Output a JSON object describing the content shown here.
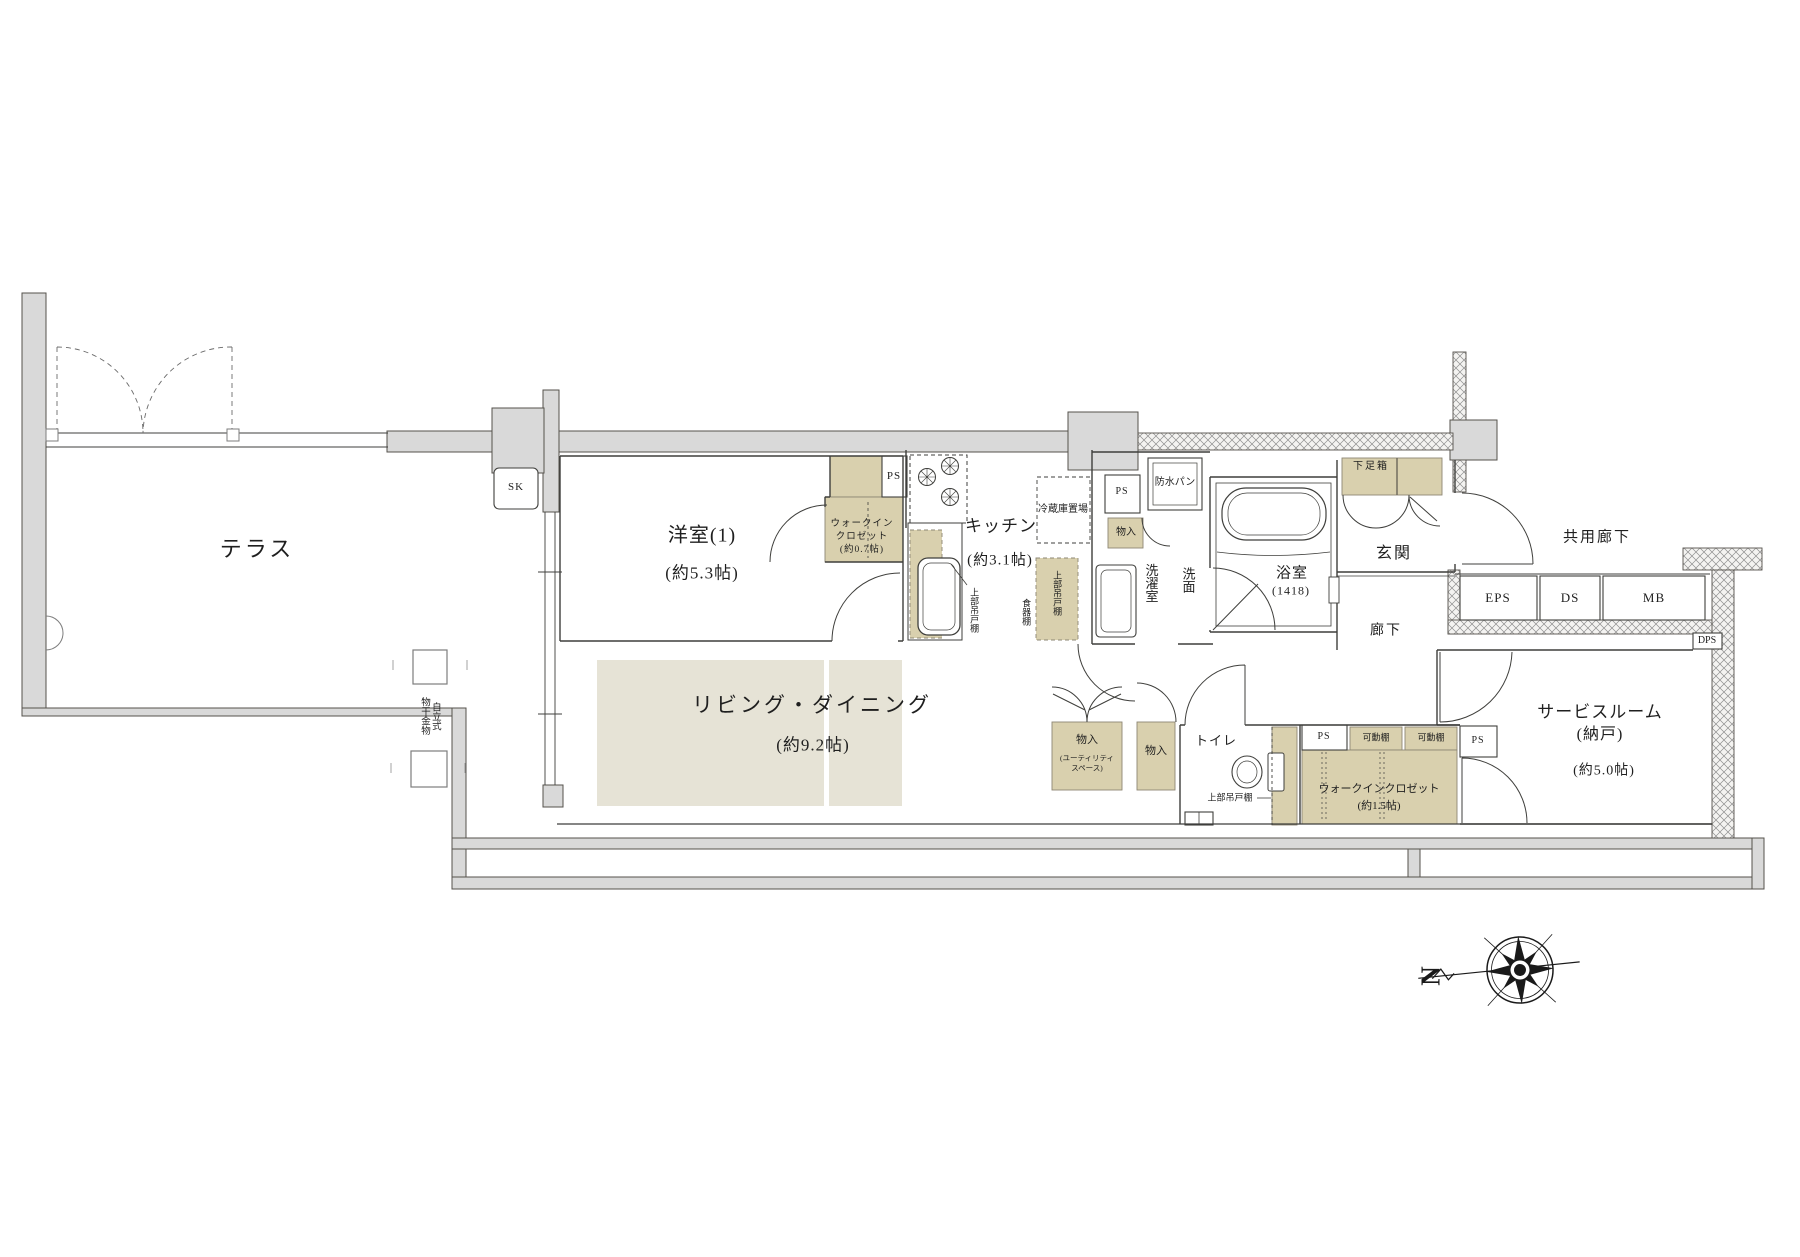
{
  "title": "マンション間取り図 (1LDK+S)",
  "colors": {
    "wall_gray": "#d9d9d9",
    "wall_edge": "#55524c",
    "line": "#3f3f3c",
    "closet_beige": "#d9d0ae",
    "floor_beige": "#e6e3d6",
    "hatch_line": "#8f8f8f"
  },
  "rooms": {
    "terrace": "テラス",
    "western1": "洋室(1)",
    "western1_size": "(約5.3帖)",
    "living": "リビング・ダイニング",
    "living_size": "(約9.2帖)",
    "kitchen": "キッチン",
    "kitchen_size": "(約3.1帖)",
    "laundry": "洗濯室",
    "washroom": "洗面",
    "bathroom": "浴室",
    "bathroom_size": "(1418)",
    "entrance": "玄関",
    "hallway": "廊下",
    "common_corridor": "共用廊下",
    "service": "サービスルーム",
    "service_sub": "(納戸)",
    "service_size": "(約5.0帖)",
    "toilet": "トイレ"
  },
  "storage": {
    "wic07": "ウォークイン\nクロゼット\n(約0.7帖)",
    "wic15": "ウォークインクロゼット",
    "wic15_size": "(約1.5帖)",
    "shoe_box": "下足箱",
    "monoire_laundry": "物入",
    "monoire_utility": "物入",
    "monoire_utility_sub": "(ユーティリティ\nスペース)",
    "monoire_hall": "物入",
    "shelf1": "可動棚",
    "shelf2": "可動棚",
    "upper_cab_kitchen": "上部吊戸棚",
    "upper_cab_cupboard": "上部吊戸棚",
    "upper_cab_toilet": "上部吊戸棚",
    "cupboard": "食器棚",
    "fridge": "冷蔵庫置場"
  },
  "shafts": {
    "ps1": "PS",
    "ps2": "PS",
    "ps3": "PS",
    "ps4": "PS",
    "eps": "EPS",
    "ds": "DS",
    "mb": "MB",
    "dps": "DPS",
    "sk": "SK"
  },
  "fixtures": {
    "waterproof_pan": "防水パン",
    "drying_pole": "自立式\n物干金物"
  },
  "compass": {
    "north": "N"
  }
}
